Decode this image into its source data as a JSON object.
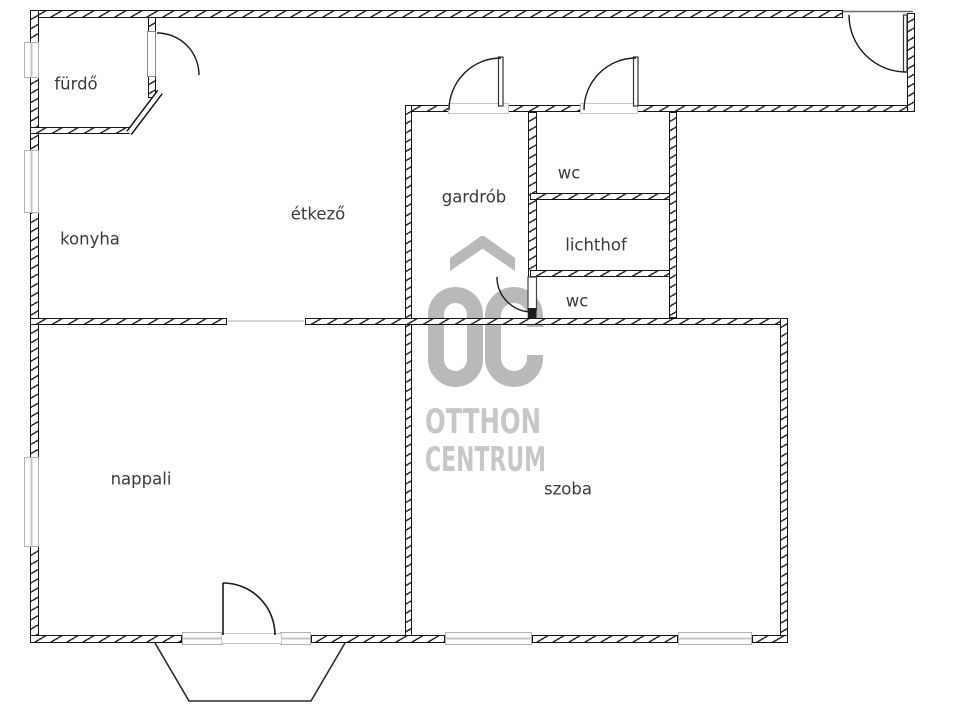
{
  "plan": {
    "type": "apartment-floor-plan",
    "wall_color": "#1a1a1a",
    "label_color": "#3a3a3a",
    "window_color": "#b3b3b3"
  },
  "rooms": {
    "furdo": {
      "label": "fürdő"
    },
    "konyha": {
      "label": "konyha"
    },
    "etkezo": {
      "label": "étkező"
    },
    "gardrob": {
      "label": "gardrób"
    },
    "wc_top": {
      "label": "wc"
    },
    "lichthof": {
      "label": "lichthof"
    },
    "wc_bottom": {
      "label": "wc"
    },
    "nappali": {
      "label": "nappali"
    },
    "szoba": {
      "label": "szoba"
    }
  },
  "watermark": {
    "monogram": "OC",
    "line1": "OTTHON",
    "line2": "CENTRUM",
    "monogram_color": "#b9b9b9",
    "text_color": "#c7c7c7"
  }
}
